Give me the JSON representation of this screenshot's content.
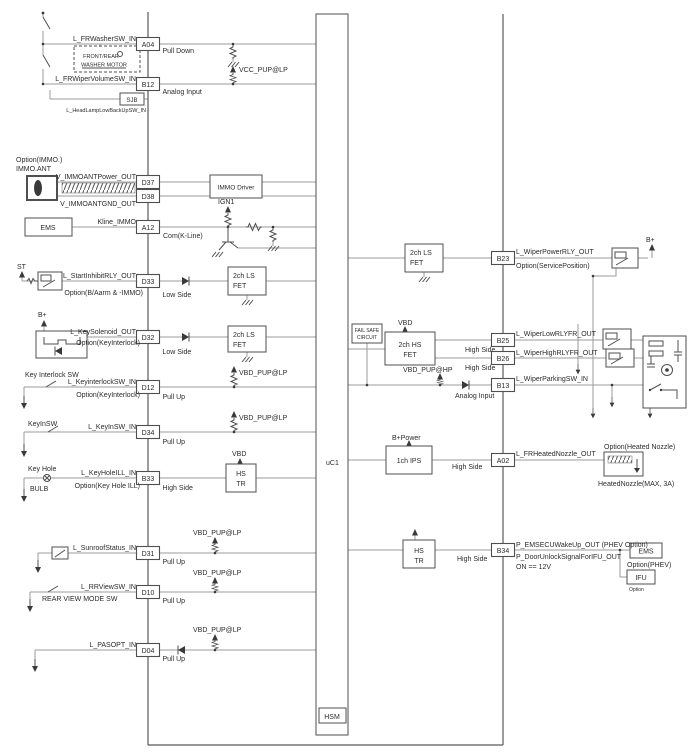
{
  "module": {
    "mcu_label": "uC1",
    "hsm_label": "HSM"
  },
  "nets": {
    "vcc_pup_lp": "VCC_PUP@LP",
    "vbd_pup_lp": "VBD_PUP@LP",
    "vbd_pup_hp": "VBD_PUP@HP",
    "vbd": "VBD",
    "b_plus": "B+",
    "b_power": "B+Power",
    "ign1": "IGN1",
    "st": "ST"
  },
  "components": {
    "immo_driver": "IMMO Driver",
    "ls_fet": {
      "l1": "2ch LS",
      "l2": "FET"
    },
    "hs_fet": {
      "l1": "2ch HS",
      "l2": "FET"
    },
    "hs_tr": {
      "l1": "HS",
      "l2": "TR"
    },
    "ips": "1ch IPS",
    "fail_safe": {
      "l1": "FAIL SAFE",
      "l2": "CIRCUIT"
    }
  },
  "left_pins": [
    {
      "id": "A04",
      "mode": "Pull Down",
      "signal": "L_FRWasherSW_IN"
    },
    {
      "id": "B12",
      "mode": "Analog Input",
      "signal": "L_FRWiperVolumeSW_IN"
    },
    {
      "id": "D37",
      "signal": "V_IMMOANTPower_OUT"
    },
    {
      "id": "D38",
      "signal": "V_IMMOANTGND_OUT"
    },
    {
      "id": "A12",
      "mode": "Com(K-Line)",
      "signal": "Kline_IMMO"
    },
    {
      "id": "D33",
      "mode": "Low Side",
      "signal": "L_StartInhibitRLY_OUT",
      "option": "Option(B/Aarm & -IMMO)"
    },
    {
      "id": "D32",
      "mode": "Low Side",
      "signal": "L_KeySolenoid_OUT",
      "option": "Option(KeyInterlock)"
    },
    {
      "id": "D12",
      "mode": "Pull Up",
      "signal": "L_KeyinterlockSW_IN",
      "option": "Option(KeyInterlock)"
    },
    {
      "id": "D34",
      "mode": "Pull Up",
      "signal": "L_KeyInSW_IN"
    },
    {
      "id": "B33",
      "mode": "High Side",
      "signal": "L_KeyHoleILL_IN",
      "option": "Option(Key Hole ILL)"
    },
    {
      "id": "D31",
      "mode": "Pull Up",
      "signal": "L_SunroofStatus_IN"
    },
    {
      "id": "D10",
      "mode": "Pull Up",
      "signal": "L_RRViewSW_IN"
    },
    {
      "id": "D04",
      "mode": "Pull Up",
      "signal": "L_PASOPT_IN"
    }
  ],
  "right_pins": [
    {
      "id": "B23",
      "signal": "L_WiperPowerRLY_OUT",
      "option": "Option(ServicePosition)"
    },
    {
      "id": "B25",
      "mode": "High Side",
      "signal": "L_WiperLowRLYFR_OUT"
    },
    {
      "id": "B26",
      "mode": "High Side",
      "signal": "L_WiperHighRLYFR_OUT"
    },
    {
      "id": "B13",
      "mode": "Analog Input",
      "signal": "L_WiperParkingSW_IN"
    },
    {
      "id": "A02",
      "mode": "High Side",
      "signal": "L_FRHeatedNozzle_OUT"
    },
    {
      "id": "B34",
      "mode": "High Side",
      "signal": "P_EMSECUWakeUp_OUT (PHEV Option)",
      "signal2": "P_DoorUnlockSignalForIFU_OUT",
      "note": "ON == 12V"
    }
  ],
  "left_external": {
    "washer_motor_l1": "FRONT/REAR",
    "washer_motor_l2": "WASHER MOTOR",
    "sjb": "SJB",
    "headlamp_signal": "L_HeadLampLowBackUpSW_IN",
    "immo_option": "Option(IMMO.)",
    "immo_ant": "IMMO.ANT",
    "ems": "EMS",
    "key_interlock_sw": "Key Interlock SW",
    "keyin_sw": "KeyInSW",
    "key_hole": "Key Hole",
    "bulb": "BULB",
    "rear_view_sw": "REAR VIEW MODE SW"
  },
  "right_external": {
    "b_plus": "B+",
    "heated_nozzle_option": "Option(Heated Nozzle)",
    "heated_nozzle": "HeatedNozzle(MAX, 3A)",
    "ems": "EMS",
    "ems_option": "Option(PHEV)",
    "ifu": "IFU",
    "ifu_option": "Option"
  }
}
